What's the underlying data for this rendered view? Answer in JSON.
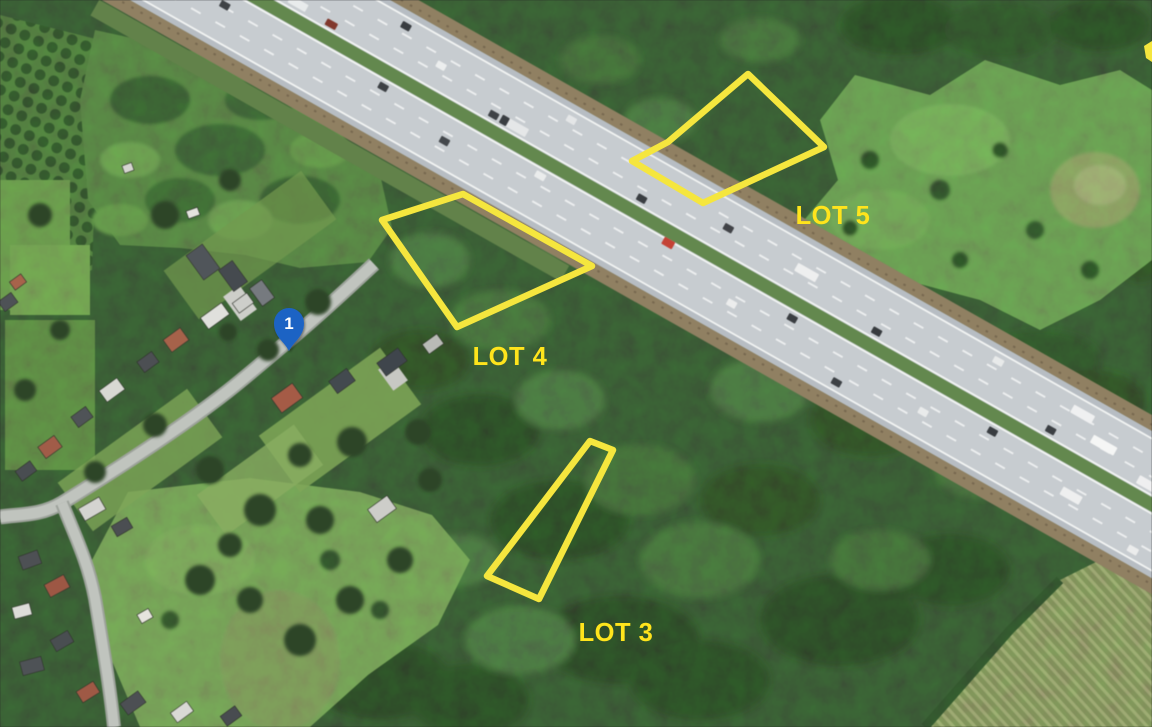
{
  "colors": {
    "lot_outline": "#F5E63E",
    "lot_label": "#FFE41C",
    "marker_blue": "#1E64C4",
    "marker_number": "#FFFFFF"
  },
  "annotations": {
    "lots": [
      {
        "id": "lot-5",
        "label": "LOT 5",
        "label_anchor": {
          "x": 833,
          "y": 224
        },
        "polygon": [
          [
            748,
            74
          ],
          [
            824,
            147
          ],
          [
            703,
            203
          ],
          [
            632,
            161
          ],
          [
            668,
            142
          ]
        ]
      },
      {
        "id": "lot-4",
        "label": "LOT 4",
        "label_anchor": {
          "x": 510,
          "y": 365
        },
        "polygon": [
          [
            463,
            194
          ],
          [
            592,
            266
          ],
          [
            457,
            327
          ],
          [
            382,
            220
          ]
        ]
      },
      {
        "id": "lot-3",
        "label": "LOT 3",
        "label_anchor": {
          "x": 616,
          "y": 641
        },
        "polygon": [
          [
            590,
            441
          ],
          [
            613,
            450
          ],
          [
            539,
            599
          ],
          [
            487,
            576
          ]
        ]
      }
    ],
    "marker": {
      "number": "1",
      "tip": {
        "x": 289,
        "y": 351
      }
    },
    "edge_fragment": {
      "points": [
        [
          1144,
          46
        ],
        [
          1152,
          41
        ],
        [
          1152,
          62
        ],
        [
          1146,
          58
        ]
      ]
    }
  }
}
